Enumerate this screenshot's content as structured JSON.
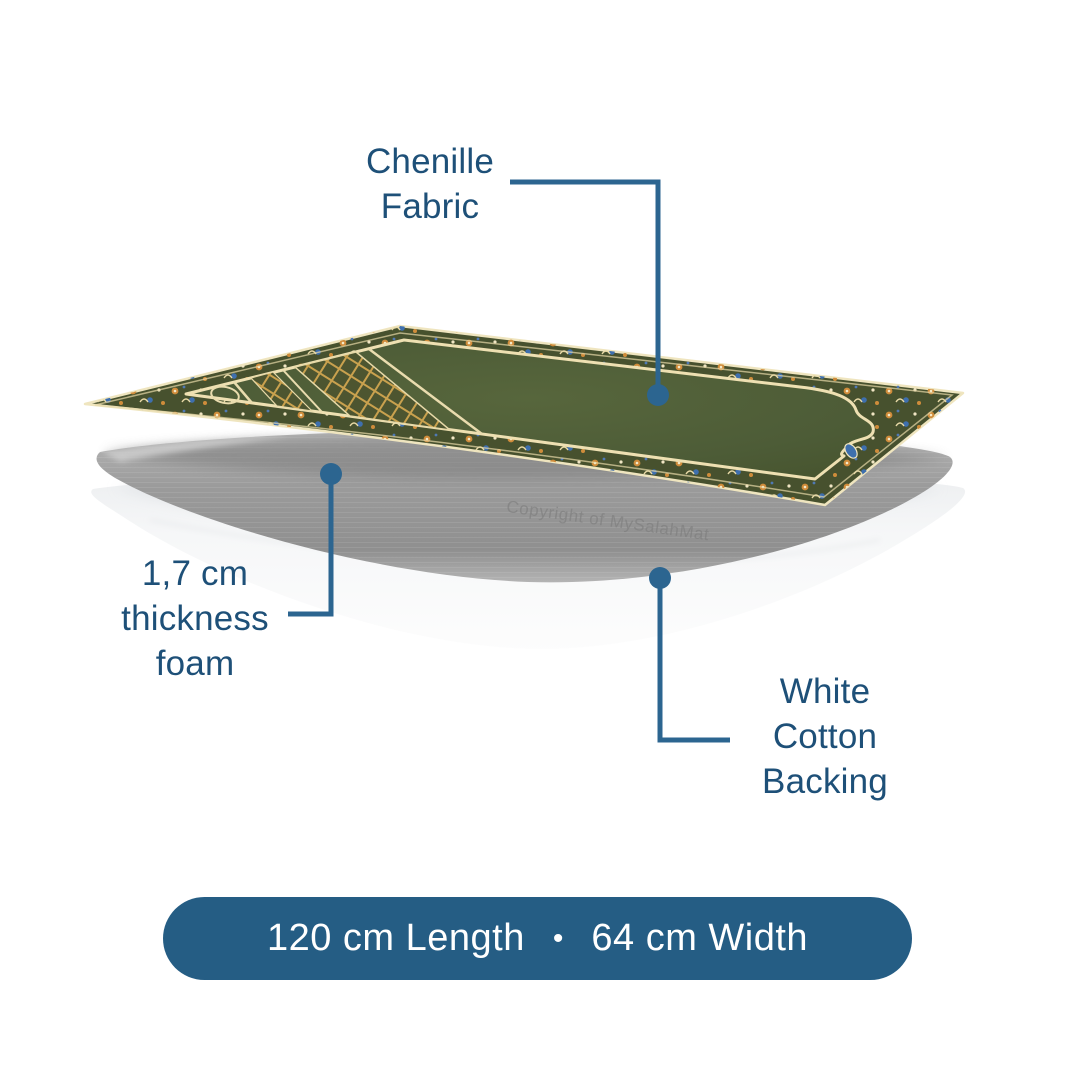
{
  "page": {
    "bg": "#ffffff"
  },
  "colors": {
    "page_bg": "#ffffff",
    "label_text": "#1e5078",
    "callout_line": "#2c6590",
    "pill_bg": "#255d84",
    "pill_text": "#ffffff",
    "fabric_green": "#4d5c37",
    "border_olive": "#47512e",
    "accent_orange": "#d08c3a",
    "accent_blue": "#3e6fae",
    "accent_cream": "#efe5bf",
    "foam_gray": "#9e9e9e",
    "backing_white": "#f4f5f7",
    "watermark_gray": "#7d7d7d"
  },
  "callouts": {
    "chenille": {
      "label_lines": [
        "Chenille",
        "Fabric"
      ]
    },
    "foam": {
      "label_lines": [
        "1,7 cm",
        "thickness",
        "foam"
      ]
    },
    "backing": {
      "label_lines": [
        "White",
        "Cotton",
        "Backing"
      ]
    }
  },
  "watermark": {
    "text": "Copyright of MySalahMat"
  },
  "size_pill": {
    "length_label": "120 cm Length",
    "separator": "•",
    "width_label": "64 cm Width"
  }
}
